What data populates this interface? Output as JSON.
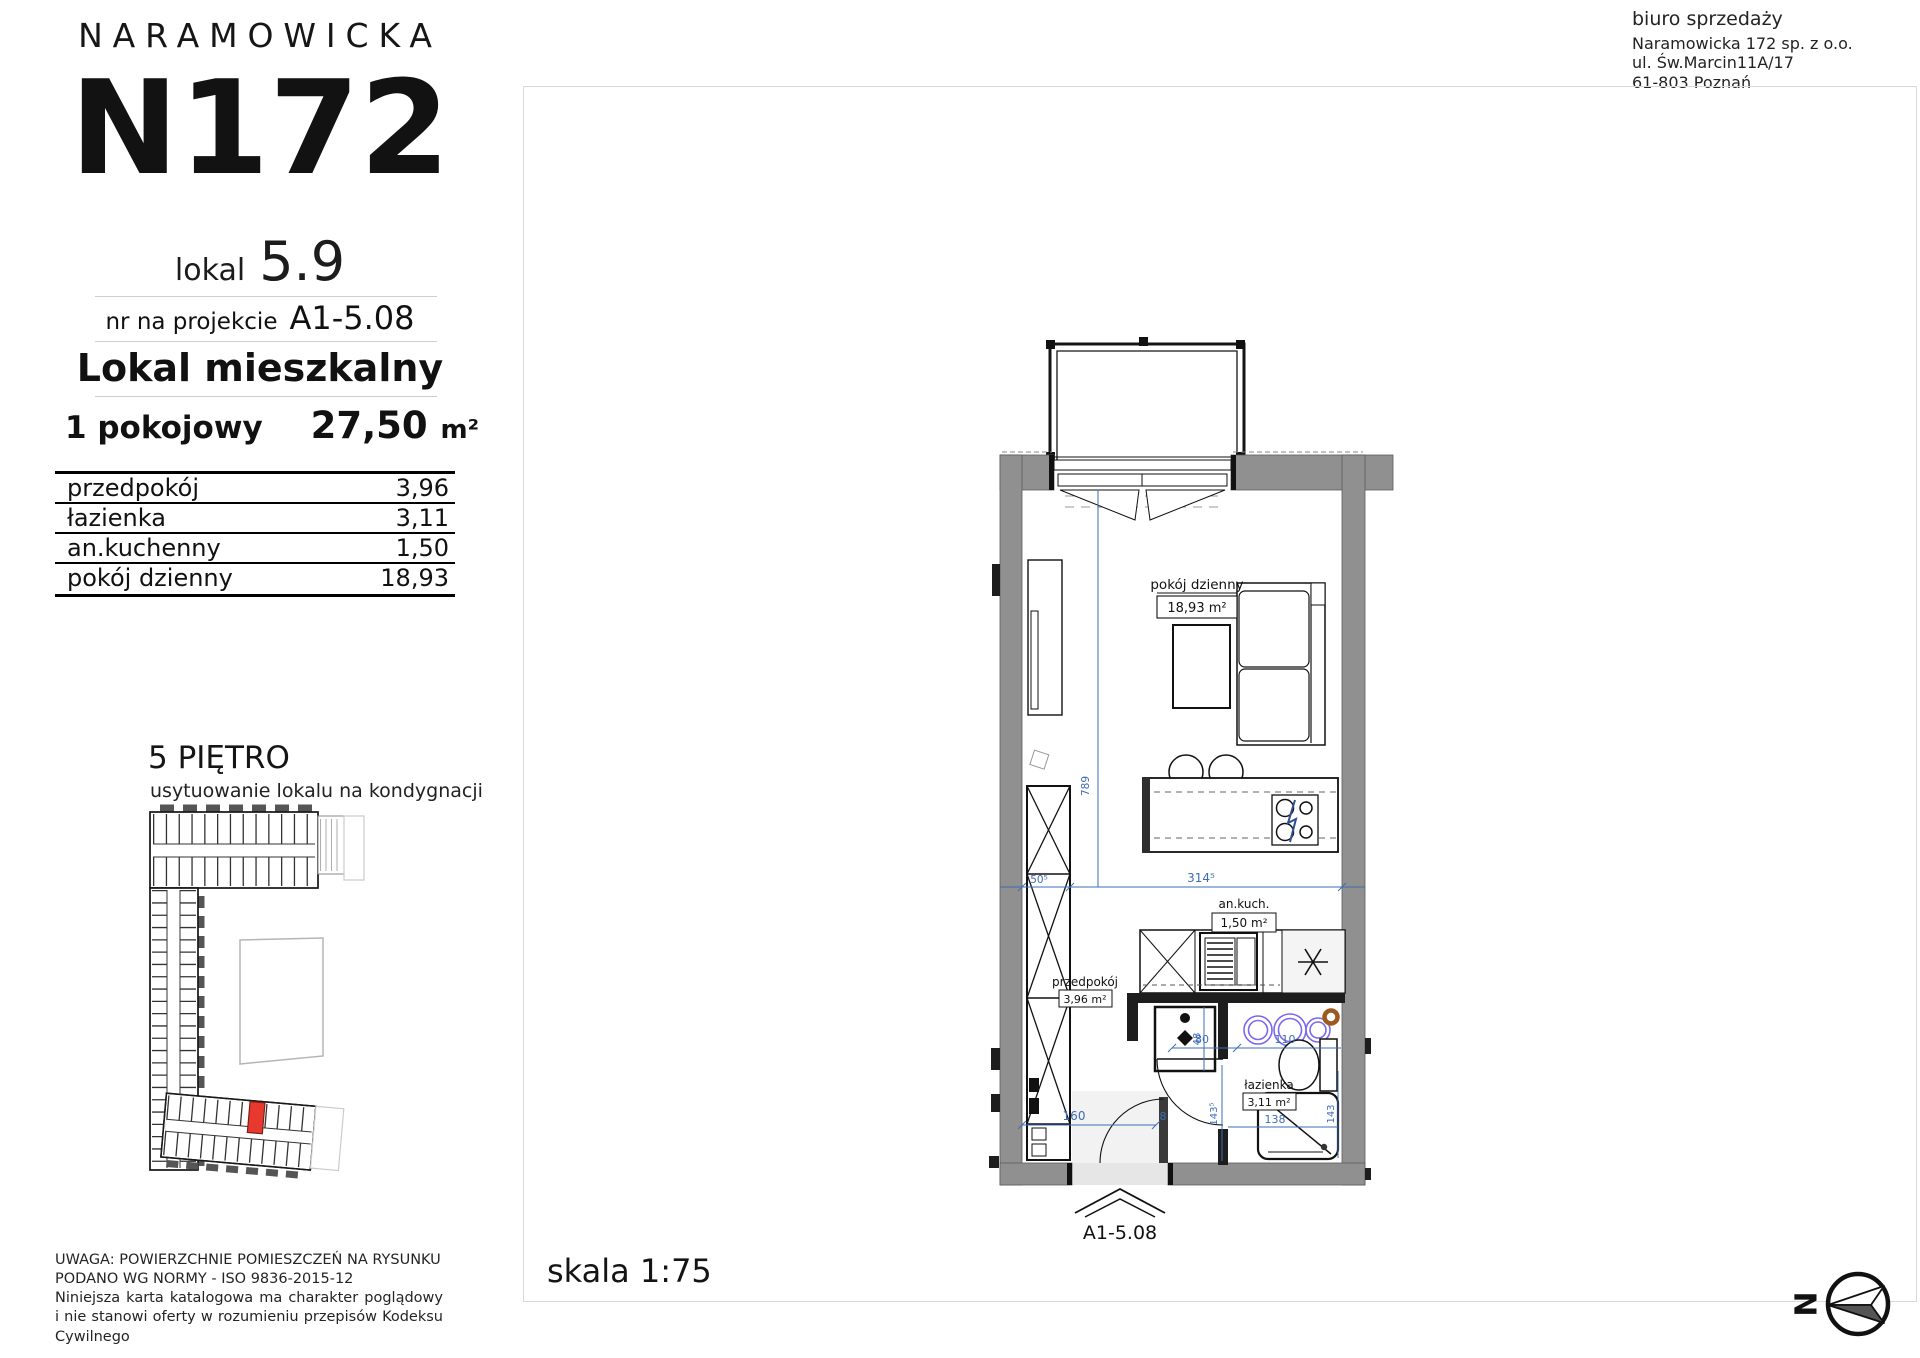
{
  "brand": {
    "name": "NARAMOWICKA",
    "logo": "N172"
  },
  "unit": {
    "lokal_label": "lokal",
    "lokal_number": "5.9",
    "project_label": "nr na projekcie",
    "project_number": "A1-5.08",
    "type_label": "Lokal mieszkalny",
    "rooms_label": "1 pokojowy",
    "area_value": "27,50",
    "area_unit": "m²"
  },
  "rooms_table": {
    "rows": [
      {
        "name": "przedpokój",
        "area": "3,96"
      },
      {
        "name": "łazienka",
        "area": "3,11"
      },
      {
        "name": "an.kuchenny",
        "area": "1,50"
      },
      {
        "name": "pokój dzienny",
        "area": "18,93"
      }
    ]
  },
  "floor_plan_key": {
    "title": "5 PIĘTRO",
    "subtitle": "usytuowanie lokalu na kondygnacji"
  },
  "sales_office": {
    "title": "biuro sprzedaży",
    "company": "Naramowicka 172 sp. z o.o.",
    "street": "ul. Św.Marcin11A/17",
    "city": "61-803 Poznań"
  },
  "notes": {
    "line1": "UWAGA: POWIERZCHNIE POMIESZCZEŃ NA RYSUNKU",
    "line2": "PODANO WG NORMY - ISO 9836-2015-12",
    "paragraph": "Niniejsza karta katalogowa ma charakter poglądowy i nie stanowi oferty w rozumieniu przepisów Kodeksu Cywilnego"
  },
  "plan": {
    "scale_label": "skala 1:75",
    "entrance_code": "A1-5.08",
    "compass_letter": "N",
    "rooms": {
      "living_name": "pokój dzienny",
      "living_area": "18,93 m²",
      "kitchen_name": "an.kuch.",
      "kitchen_area": "1,50 m²",
      "hall_name": "przedpokój",
      "hall_area": "3,96 m²",
      "bath_name": "łazienka",
      "bath_area": "3,11 m²"
    },
    "dimensions": {
      "total_width": "314⁵",
      "closet_width": "50⁵",
      "room_depth": "789",
      "hall_width": "160",
      "door_width": "8",
      "shaft": "48",
      "bath_door": "80",
      "bath_width": "110",
      "hall_depth": "143⁵",
      "bath_bottom": "138",
      "bath_depth": "143"
    }
  },
  "colors": {
    "unit_highlight": "#e8392e",
    "dimension_blue": "#3e6db5",
    "wall_gray": "#909090"
  }
}
